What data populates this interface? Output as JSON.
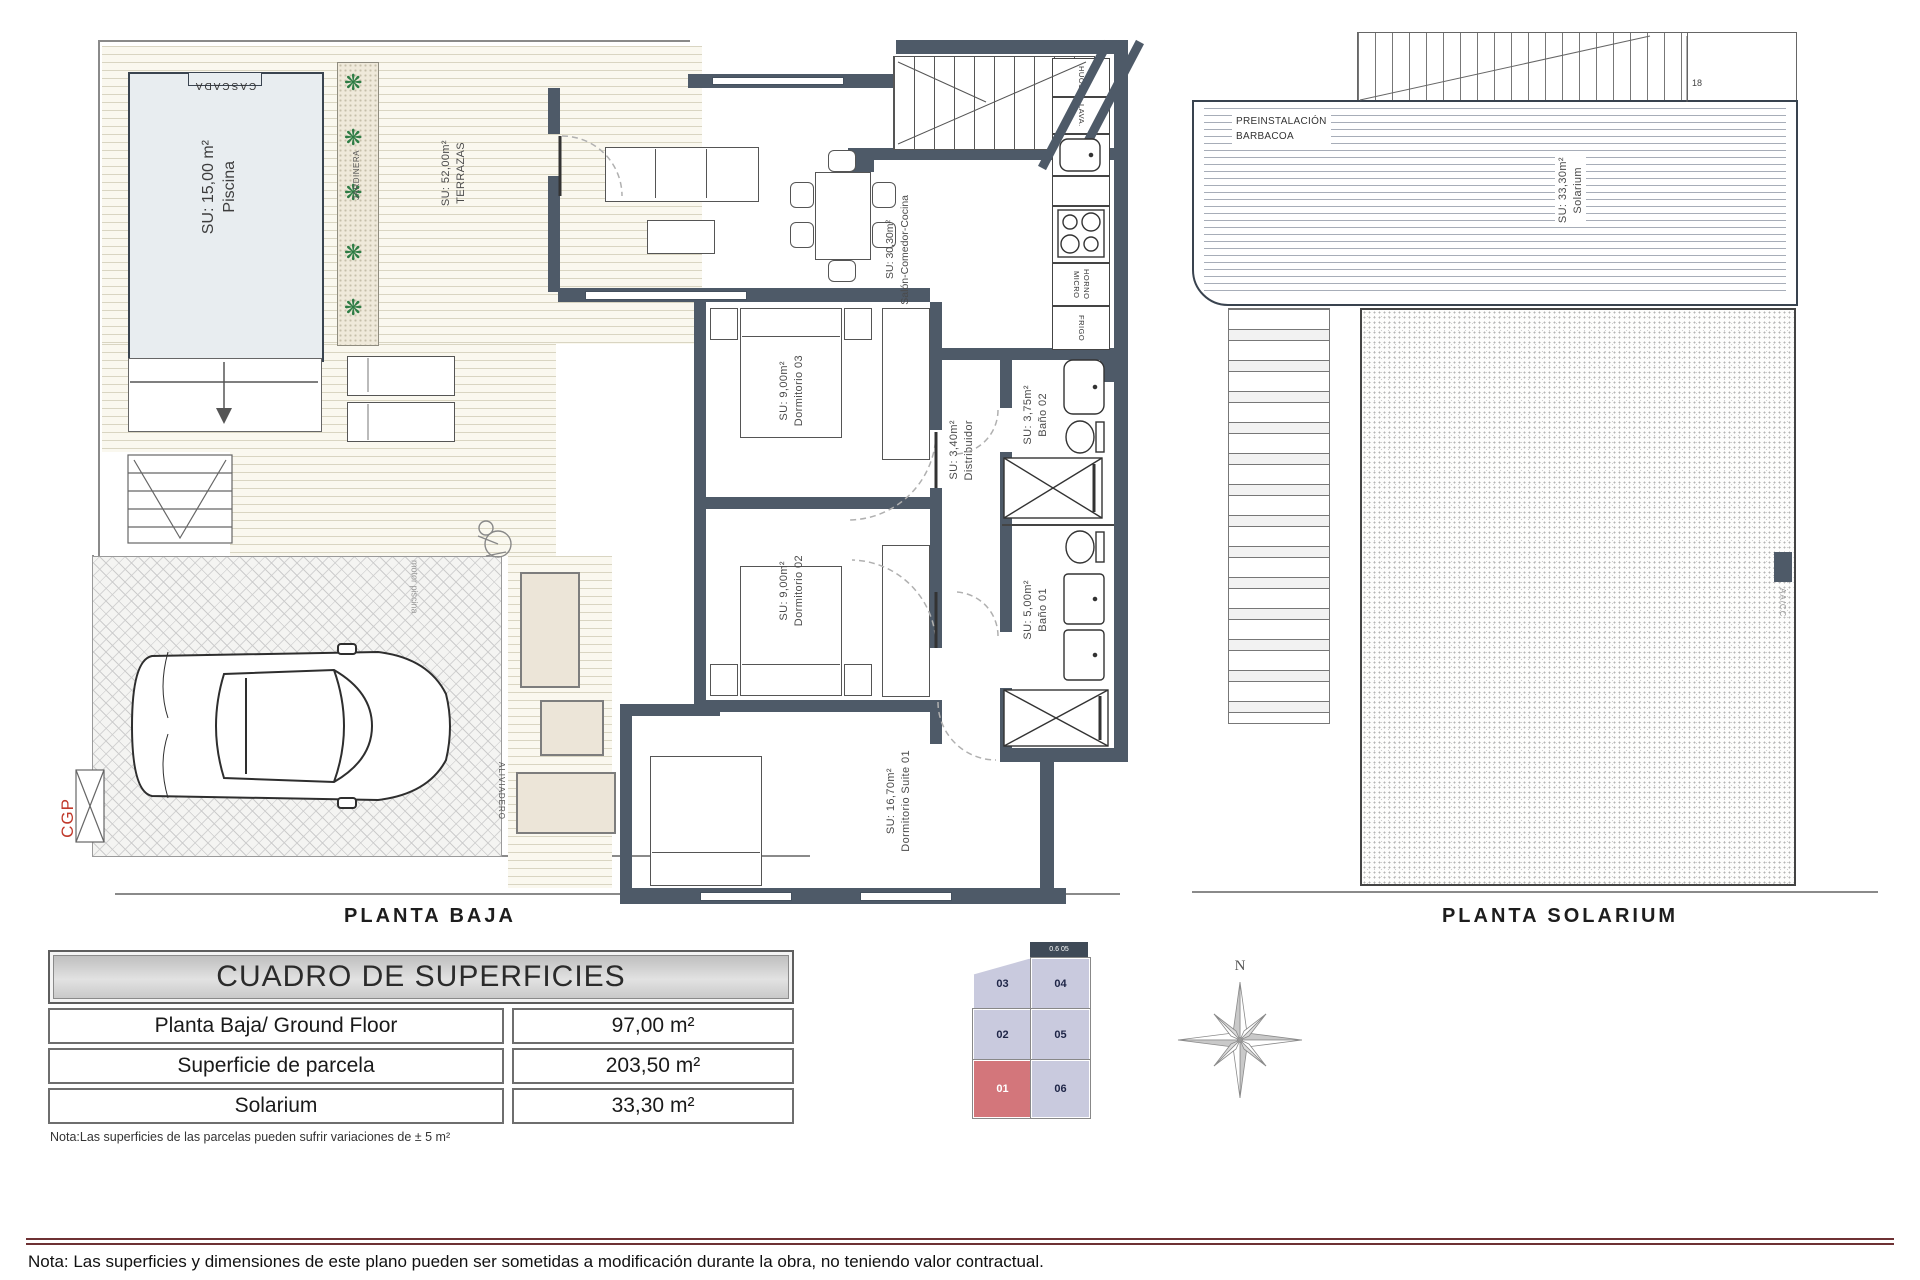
{
  "palette": {
    "wall_color": "#4e5a68",
    "highlight_red": "#d3767b",
    "plot_lavender": "#c9cade",
    "footer_line_color": "#6e3134"
  },
  "icons": {
    "plant": "❋",
    "north": "N"
  },
  "planta_baja": {
    "caption": "PLANTA BAJA",
    "labels": {
      "cascada": "CASCADA",
      "piscina_name": "Piscina",
      "piscina_area": "SU: 15,00 m²",
      "jardinera": "JARDINERA",
      "terrazas_name": "TERRAZAS",
      "terrazas_area": "SU: 52,00m²",
      "salon_name": "Salón-Comedor-Cocina",
      "salon_area": "SU: 30,30m²",
      "dorm3_name": "Dormitorio 03",
      "dorm3_area": "SU: 9,00m²",
      "dorm2_name": "Dormitorio 02",
      "dorm2_area": "SU: 9,00m²",
      "suite_name": "Dormitorio Suite 01",
      "suite_area": "SU: 16,70m²",
      "distribuidor_name": "Distribuidor",
      "distribuidor_area": "SU: 3,40m²",
      "bano2_name": "Baño 02",
      "bano2_area": "SU: 3,75m²",
      "bano1_name": "Baño 01",
      "bano1_area": "SU: 5,00m²",
      "motor_piscina": "motor piscina",
      "aliviadero": "ALIVIADERO",
      "cgp": "CGP"
    },
    "kitchen": {
      "c1": "HUOS",
      "c2": "LAVA.",
      "c5": "HORNO MICRO",
      "c6": "FRIGO"
    }
  },
  "planta_solarium": {
    "caption": "PLANTA SOLARIUM",
    "labels": {
      "preinstalacion_l1": "PREINSTALACIÓN",
      "preinstalacion_l2": "BARBACOA",
      "solarium_name": "Solarium",
      "solarium_area": "SU: 33,30m²",
      "aacc": "AA/CC",
      "stair_number": "18"
    }
  },
  "table": {
    "title": "CUADRO DE SUPERFICIES",
    "rows": [
      {
        "label": "Planta Baja/ Ground Floor",
        "value": "97,00 m²"
      },
      {
        "label": "Superficie de parcela",
        "value": "203,50 m²"
      },
      {
        "label": "Solarium",
        "value": "33,30 m²"
      }
    ],
    "note": "Nota:Las superficies de las parcelas pueden sufrir variaciones de ± 5 m²"
  },
  "plot_map": {
    "top_label": "0.6 05",
    "cells": [
      {
        "id": "03",
        "color": "#c9cade",
        "text_color": "#1e2547"
      },
      {
        "id": "04",
        "color": "#c9cade",
        "text_color": "#1e2547"
      },
      {
        "id": "02",
        "color": "#c9cade",
        "text_color": "#1e2547"
      },
      {
        "id": "05",
        "color": "#c9cade",
        "text_color": "#1e2547"
      },
      {
        "id": "01",
        "color": "#d3767b",
        "text_color": "#ffffff"
      },
      {
        "id": "06",
        "color": "#c9cade",
        "text_color": "#1e2547"
      }
    ]
  },
  "footer": {
    "note": "Nota: Las superficies y dimensiones de este plano pueden ser sometidas a modificación durante la obra, no teniendo valor contractual."
  }
}
